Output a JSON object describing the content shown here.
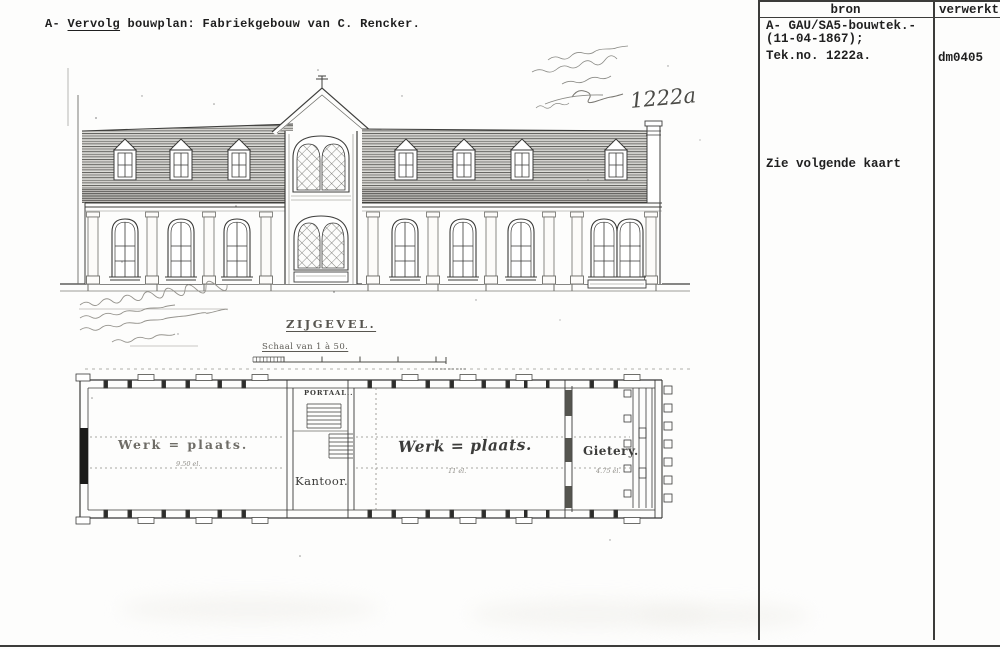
{
  "header": {
    "prefix": "A- ",
    "underlined": "Vervolg",
    "rest": " bouwplan: Fabriekgebouw van C. Rencker."
  },
  "catalog_panel": {
    "columns": {
      "bron": "bron",
      "verwerkt": "verwerkt"
    },
    "bron_entry_lines": [
      "A- GAU/SA5-bouwtek.-",
      "(11-04-1867);",
      "Tek.no. 1222a."
    ],
    "verwerkt_entry": "dm0405",
    "note": "Zie volgende kaart"
  },
  "drawing": {
    "handwritten_drawing_number": "1222a",
    "elevation_caption": "ZIJGEVEL.",
    "scale_caption": "Schaal van 1 à 50.",
    "plan": {
      "portaal_label": "PORTAAL..",
      "kantoor_label": "Kantoor.",
      "workshop_left_label": "Werk = plaats.",
      "workshop_left_dim": "9.50 el.",
      "workshop_center_label": "Werk = plaats.",
      "workshop_center_dim": "11 el.",
      "foundry_label": "Gietery.",
      "foundry_dim": "4.75 el."
    }
  },
  "colors": {
    "ink": "#1f1f1f",
    "drawing_line": "#3f3f3d",
    "faded_ink": "#8f8d87"
  }
}
